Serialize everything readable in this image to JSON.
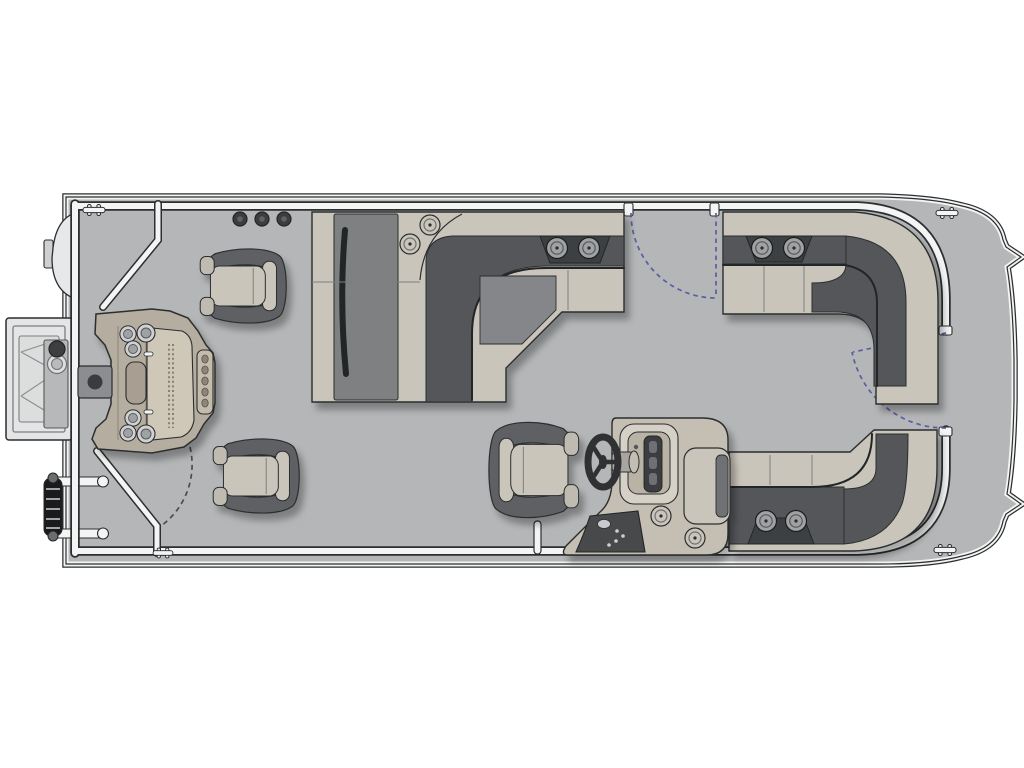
{
  "title": "Pontoon boat floor plan - overhead view",
  "palette": {
    "background": "#ffffff",
    "deck": "#b4b6b8",
    "fence": "#f3f4f4",
    "outline": "#2c2e2f",
    "near_black": "#232526",
    "seat_base": "#cac5bb",
    "seat_back": "#54565a",
    "cushion_mid": "#84868a",
    "chaise_mid": "#7e8082",
    "chair_dark": "#5f6164",
    "chair_cap": "#bfbbb1",
    "console": "#c5bfb3",
    "console_light": "#d6d1c7",
    "panel_dark": "#46484b",
    "station": "#b5ad9f",
    "station_table": "#cfc7b7",
    "pad_gray": "#8b8d90",
    "white_part": "#e7e8e9",
    "ladder_black": "#1a1b1d",
    "tray_dark": "#3e4043",
    "swing_arc": "#5c5da0",
    "swing_arc_gray": "#4a4c4e"
  },
  "boat": {
    "orientation": {
      "bow": "right",
      "stern": "left"
    },
    "counts": {
      "fishing_chairs": 2,
      "helm_chairs": 1,
      "lounge_benches": 3,
      "gates": 3,
      "cleats": 4,
      "rail_rod_holders": 3,
      "station_cup_holders": 6,
      "bench_cup_holders": 8
    },
    "labels": {
      "hull": "Pontoon deck and bow platform",
      "perimeter_fence": "Perimeter fence rail",
      "stern_fence": "Aft angled fence rails",
      "midship_lounge": "Midship L-shaped lounge",
      "bow_stbd_bench": "Forward starboard L-bench",
      "bow_port_bench": "Forward port L-bench",
      "helm": "Helm console",
      "steering_wheel": "Steering wheel",
      "helm_chair": "Helm captain chair",
      "fishing_chair_stbd": "Aft starboard fishing chair",
      "fishing_chair_port": "Aft port fishing chair",
      "fishing_station": "Stern fishing station with cup holders and tool slots",
      "pedal_pad": "Trolling pedal pad",
      "motor_mount": "Stern motor mount frame",
      "ladder": "Boarding ladder",
      "cleat": "Mooring cleat",
      "rod_holders": "Rail rod holders",
      "gate_stbd": "Starboard boarding gate with swing arc",
      "gate_bow": "Bow platform gate with swing arc",
      "gate_aft": "Aft port gate swing arc",
      "gate_post": "Port side gate post",
      "cup_holder": "Cup holder",
      "bow_platform": "Bow platform with cleats"
    }
  }
}
